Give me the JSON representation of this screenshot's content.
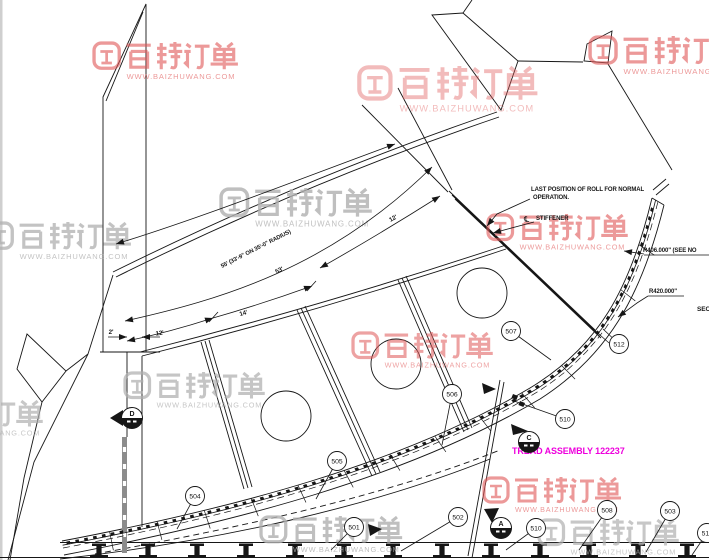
{
  "drawing": {
    "colors": {
      "line": "#161616",
      "magenta": "#ee00dd",
      "watermark_red": "#e05757",
      "watermark_gray": "#b0b0b0",
      "cut_bar_gray": "#8c8c8c",
      "edge_gray": "#cfcfcf"
    },
    "watermark": {
      "brand": "百铸订单",
      "url": "WWW.BAIZHUWANG.COM",
      "instances": [
        {
          "x": 93,
          "y": 42,
          "s": 1.05,
          "c": "red",
          "o": 0.6
        },
        {
          "x": 358,
          "y": 66,
          "s": 1.3,
          "c": "red",
          "o": 0.4
        },
        {
          "x": 589,
          "y": 36,
          "s": 1.08,
          "c": "red",
          "o": 0.6
        },
        {
          "x": -14,
          "y": 222,
          "s": 1.05,
          "c": "gray",
          "o": 0.75
        },
        {
          "x": 220,
          "y": 188,
          "s": 1.1,
          "c": "gray",
          "o": 0.8
        },
        {
          "x": 487,
          "y": 214,
          "s": 1.02,
          "c": "red",
          "o": 0.6
        },
        {
          "x": 352,
          "y": 332,
          "s": 1.02,
          "c": "red",
          "o": 0.55
        },
        {
          "x": 124,
          "y": 372,
          "s": 1.02,
          "c": "gray",
          "o": 0.72
        },
        {
          "x": -98,
          "y": 400,
          "s": 1.02,
          "c": "gray",
          "o": 0.7
        },
        {
          "x": 483,
          "y": 477,
          "s": 1.0,
          "c": "red",
          "o": 0.6
        },
        {
          "x": 260,
          "y": 516,
          "s": 1.03,
          "c": "gray",
          "o": 0.8
        },
        {
          "x": 538,
          "y": 519,
          "s": 1.02,
          "c": "gray",
          "o": 0.7
        }
      ]
    },
    "annotations": [
      {
        "id": "last-position-line1",
        "text": "LAST POSITION OF ROLL FOR NORMAL",
        "x": 531,
        "y": 191,
        "size": 6,
        "bold": true
      },
      {
        "id": "last-position-line2",
        "text": "OPERATION.",
        "x": 533,
        "y": 199,
        "size": 6,
        "bold": true
      },
      {
        "id": "centerline-symbol",
        "text": "℄",
        "x": 524,
        "y": 222,
        "size": 8,
        "bold": false
      },
      {
        "id": "stiffener-label",
        "text": "STIFFENER",
        "x": 536,
        "y": 220,
        "size": 6,
        "bold": true
      },
      {
        "id": "radius-406",
        "text": "R406.000\" (SEE NO",
        "x": 643,
        "y": 252,
        "size": 6,
        "bold": true
      },
      {
        "id": "radius-420",
        "text": "R420.000\"",
        "x": 649,
        "y": 293,
        "size": 6,
        "bold": true
      },
      {
        "id": "section-title-partial",
        "text": "SECT",
        "x": 697,
        "y": 311,
        "size": 6.5,
        "bold": true
      },
      {
        "id": "tread-assembly-label",
        "text": "TREAD ASSEMBLY  122237",
        "x": 512,
        "y": 454,
        "size": 9,
        "bold": true,
        "color": "#ee00dd"
      }
    ],
    "dim_labels": [
      {
        "id": "dim-55ft",
        "text": "55' (33'-9\" ON 35'-0\" RADIUS)",
        "x": 222,
        "y": 268,
        "rot": -27,
        "size": 5.8,
        "anchor": "start"
      },
      {
        "id": "dim-53ft",
        "text": "53'",
        "x": 280,
        "y": 272,
        "rot": -25,
        "size": 6.2,
        "anchor": "middle"
      },
      {
        "id": "dim-14ft",
        "text": "14'",
        "x": 244,
        "y": 315,
        "rot": -17,
        "size": 6.2,
        "anchor": "middle"
      },
      {
        "id": "dim-12ft-left",
        "text": "12'",
        "x": 160,
        "y": 335,
        "rot": -9,
        "size": 6.2,
        "anchor": "middle"
      },
      {
        "id": "dim-2ft",
        "text": "2'",
        "x": 111,
        "y": 334,
        "rot": 0,
        "size": 6.2,
        "anchor": "middle"
      },
      {
        "id": "dim-12ft-top",
        "text": "12'",
        "x": 394,
        "y": 220,
        "rot": -29,
        "size": 6.2,
        "anchor": "middle"
      }
    ],
    "balloons": [
      {
        "n": "501",
        "x": 354,
        "y": 527,
        "lx": 331,
        "ly": 550
      },
      {
        "n": "502",
        "x": 458,
        "y": 517,
        "lx": 401,
        "ly": 551
      },
      {
        "n": "503",
        "x": 670,
        "y": 511,
        "lx": 646,
        "ly": 552
      },
      {
        "n": "504",
        "x": 195,
        "y": 496,
        "lx": 177,
        "ly": 529
      },
      {
        "n": "505",
        "x": 337,
        "y": 461,
        "lx": 316,
        "ly": 499
      },
      {
        "n": "506",
        "x": 452,
        "y": 394,
        "lx": 442,
        "ly": 445
      },
      {
        "n": "507",
        "x": 511,
        "y": 331,
        "lx": 551,
        "ly": 360
      },
      {
        "n": "508",
        "x": 607,
        "y": 510,
        "lx": 579,
        "ly": 550
      },
      {
        "n": "510",
        "x": 565,
        "y": 419,
        "lx": 514,
        "ly": 401
      },
      {
        "n": "510",
        "x": 536,
        "y": 528,
        "lx": 506,
        "ly": 550
      },
      {
        "n": "511",
        "x": 707,
        "y": 533,
        "lx": 692,
        "ly": 555
      },
      {
        "n": "512",
        "x": 619,
        "y": 344,
        "lx": 603,
        "ly": 329
      }
    ],
    "section_markers": [
      {
        "letter": "D",
        "x": 132,
        "y": 418,
        "tri": "110,418 123,410 123,426"
      },
      {
        "letter": "A",
        "x": 501,
        "y": 528,
        "tri": "484,509 499,508 492,523"
      },
      {
        "letter": "C",
        "x": 529,
        "y": 442,
        "tri": "511,424 528,431 513,435"
      }
    ],
    "flags": [
      {
        "id": "flag-near-501",
        "pts": "368,524 382,529 370,536"
      },
      {
        "id": "flag-mid-band",
        "pts": "482,383 496,389 484,394"
      }
    ]
  }
}
